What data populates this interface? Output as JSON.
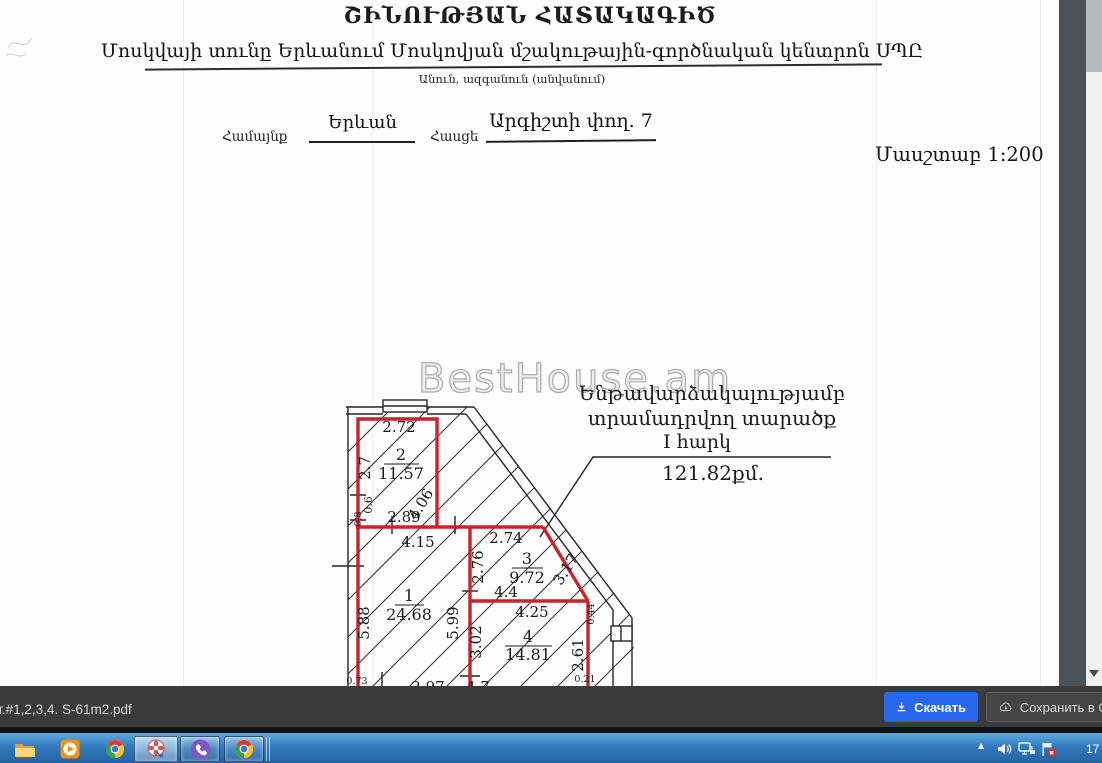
{
  "doc": {
    "title": "ՇԻՆՈՒԹՅԱՆ ՀԱՏԱԿԱԳԻԾ",
    "subtitle": "Մոսկվայի տունը Երևանում Մոսկովյան մշակութային-գործնական կենտրոն ՍՊԸ",
    "subtitle_caption": "Անուն, ազգանուն (անվանում)",
    "community_label": "Համայնք",
    "community_value": "Երևան",
    "address_label": "Հասցե",
    "address_value": "Արգիշտի փող. 7",
    "scale": "Մասշտաբ 1:200",
    "watermark": "BestHouse.am",
    "callout": {
      "line1": "Ենթավարձակալությամբ",
      "line2": "տրամադրվող տարածք",
      "line3": "I հարկ",
      "area": "121.82քմ."
    }
  },
  "plan": {
    "rooms": [
      {
        "number": "1",
        "area": "24.68"
      },
      {
        "number": "2",
        "area": "11.57"
      },
      {
        "number": "3",
        "area": "9.72"
      },
      {
        "number": "4",
        "area": "14.81"
      }
    ],
    "dims": {
      "d272": "2.72",
      "d27": "2.7",
      "d06": "0.6",
      "d08": "0.8",
      "d289": "2.89",
      "d406": "4.06",
      "d415": "4.15",
      "d274": "2.74",
      "d276": "2.76",
      "d317": "3.17",
      "d44": "4.4",
      "d588": "5.88",
      "d599": "5.99",
      "d302": "3.02",
      "d425": "4.25",
      "d261": "2.61",
      "d044": "0.44",
      "d297": "2.97",
      "d47": "4.7",
      "d073": "0.73",
      "d021": "0.21"
    }
  },
  "viewer": {
    "filename": "от.#1,2,3,4. S-61m2.pdf",
    "download_label": "Скачать",
    "save_label": "Сохранить в Обл",
    "accent_color": "#2968ee"
  },
  "taskbar": {
    "items": [
      "explorer",
      "media-player",
      "chrome",
      "screenshot-tool",
      "viber",
      "chrome"
    ],
    "tray": [
      "hidden-icons",
      "volume",
      "network",
      "action-center"
    ],
    "clock": "17"
  }
}
